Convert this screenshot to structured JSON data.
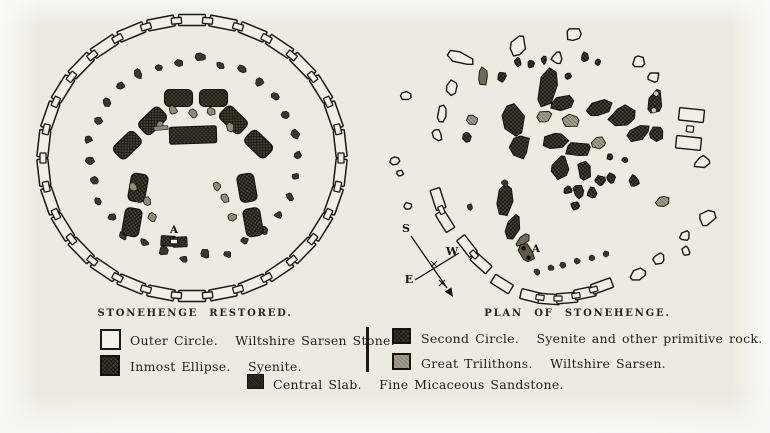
{
  "page": {
    "colors": {
      "paper": "#edeae1",
      "ink": "#241f17",
      "dark_stone": "#4b463a",
      "gray_stone": "#a39e8c",
      "outline_stone": "#f1eee6"
    }
  },
  "titles": {
    "left": "STONEHENGE RESTORED.",
    "right": "PLAN OF STONEHENGE."
  },
  "legend": {
    "outer_circle": {
      "label": "Outer Circle.   Wiltshire Sarsen Stone."
    },
    "inmost_ellipse": {
      "label": "Inmost Ellipse.   Syenite."
    },
    "central_slab": {
      "label": "Central Slab.   Fine Micaceous Sandstone."
    },
    "second_circle": {
      "label": "Second Circle.   Syenite and other primitive rock."
    },
    "great_trilithons": {
      "label": "Great Trilithons.   Wiltshire Sarsen."
    }
  },
  "left_plan": {
    "label_a": "A",
    "center": [
      172,
      154
    ],
    "outer_ring": {
      "rx": 149,
      "ry": 138,
      "links": 30,
      "link_len": 27,
      "link_w": 11,
      "joint_len": 10,
      "joint_w": 6
    },
    "bluestone_ring": {
      "rx": 103,
      "ry": 99,
      "count": 30
    },
    "trilithons": [
      [
        176,
        94,
        0
      ],
      [
        120,
        129,
        -44
      ],
      [
        226,
        128,
        44
      ],
      [
        115,
        201,
        -80
      ],
      [
        230,
        201,
        80
      ]
    ],
    "trilithon_stone": {
      "len": 28,
      "wid": 17,
      "gap": 7
    },
    "slab": [
      173,
      131,
      47,
      17,
      -2
    ],
    "gray_dots": [
      [
        153,
        106
      ],
      [
        173,
        109
      ],
      [
        191,
        107
      ],
      [
        140,
        121
      ],
      [
        210,
        123
      ],
      [
        113,
        183
      ],
      [
        127,
        197
      ],
      [
        132,
        213
      ],
      [
        205,
        194
      ],
      [
        212,
        213
      ],
      [
        197,
        182
      ]
    ],
    "gray_bar": [
      141,
      124,
      14,
      4
    ],
    "a_pos": [
      154,
      229
    ],
    "pair": [
      [
        148,
        237,
        4
      ],
      [
        160,
        238,
        -3
      ]
    ],
    "pair_size": [
      14,
      10
    ]
  },
  "right_plan": {
    "label_a": "A",
    "a_pos": [
      151,
      252
    ],
    "compass": {
      "labels": {
        "s": "S",
        "w": "W",
        "e": "E"
      },
      "s_pos": [
        21,
        232
      ],
      "w_pos": [
        67,
        255
      ],
      "e_pos": [
        24,
        283
      ],
      "line1": [
        [
          26,
          236
        ],
        [
          62,
          288
        ]
      ],
      "line2": [
        [
          30,
          280
        ],
        [
          74,
          253
        ]
      ],
      "arrow_tip": [
        68,
        297
      ],
      "ticks": [
        [
          49,
          264
        ],
        [
          57,
          283
        ]
      ]
    },
    "stones": [
      [
        75,
        58,
        28,
        12,
        22,
        "o"
      ],
      [
        67,
        88,
        13,
        16,
        -8,
        "o"
      ],
      [
        57,
        114,
        9,
        20,
        10,
        "o"
      ],
      [
        52,
        135,
        9,
        13,
        -25,
        "o"
      ],
      [
        21,
        96,
        13,
        9,
        10,
        "o"
      ],
      [
        10,
        161,
        10,
        8,
        0,
        "o"
      ],
      [
        15,
        173,
        7,
        6,
        0,
        "o"
      ],
      [
        23,
        206,
        9,
        7,
        0,
        "o"
      ],
      [
        133,
        46,
        17,
        22,
        8,
        "o"
      ],
      [
        189,
        34,
        18,
        14,
        -12,
        "o"
      ],
      [
        172,
        58,
        11,
        13,
        0,
        "o"
      ],
      [
        254,
        62,
        13,
        12,
        15,
        "o"
      ],
      [
        269,
        77,
        12,
        10,
        -10,
        "o"
      ],
      [
        270,
        102,
        16,
        30,
        8,
        "d2"
      ],
      [
        305,
        129,
        20,
        52,
        6,
        "ol"
      ],
      [
        317,
        162,
        17,
        12,
        -22,
        "o"
      ],
      [
        322,
        218,
        18,
        14,
        -32,
        "o"
      ],
      [
        300,
        236,
        11,
        10,
        -30,
        "o"
      ],
      [
        301,
        251,
        8,
        10,
        0,
        "o"
      ],
      [
        274,
        259,
        14,
        11,
        -35,
        "o"
      ],
      [
        253,
        275,
        16,
        12,
        -30,
        "o"
      ],
      [
        163,
        88,
        19,
        44,
        9,
        "d"
      ],
      [
        128,
        120,
        23,
        32,
        -14,
        "d"
      ],
      [
        135,
        147,
        21,
        25,
        26,
        "d"
      ],
      [
        178,
        103,
        27,
        15,
        -8,
        "d"
      ],
      [
        213,
        108,
        29,
        17,
        -20,
        "d"
      ],
      [
        238,
        116,
        31,
        19,
        -25,
        "d"
      ],
      [
        253,
        133,
        25,
        15,
        -32,
        "d"
      ],
      [
        271,
        134,
        15,
        18,
        -8,
        "d"
      ],
      [
        170,
        141,
        27,
        18,
        8,
        "d"
      ],
      [
        193,
        149,
        29,
        16,
        -4,
        "d"
      ],
      [
        175,
        168,
        18,
        25,
        4,
        "d"
      ],
      [
        199,
        170,
        14,
        21,
        -12,
        "d"
      ],
      [
        215,
        181,
        12,
        11,
        0,
        "d"
      ],
      [
        183,
        190,
        10,
        9,
        0,
        "d"
      ],
      [
        117,
        77,
        10,
        10,
        0,
        "d"
      ],
      [
        133,
        62,
        7,
        10,
        0,
        "d"
      ],
      [
        146,
        64,
        7,
        8,
        0,
        "d"
      ],
      [
        159,
        60,
        6,
        9,
        0,
        "d"
      ],
      [
        200,
        57,
        8,
        10,
        0,
        "d"
      ],
      [
        213,
        62,
        6,
        7,
        0,
        "d"
      ],
      [
        183,
        76,
        7,
        7,
        0,
        "d"
      ],
      [
        82,
        137,
        9,
        11,
        0,
        "d"
      ],
      [
        120,
        199,
        16,
        38,
        12,
        "d"
      ],
      [
        128,
        227,
        13,
        27,
        18,
        "d"
      ],
      [
        194,
        191,
        12,
        15,
        -10,
        "d"
      ],
      [
        207,
        193,
        10,
        12,
        0,
        "d"
      ],
      [
        190,
        206,
        9,
        9,
        0,
        "d"
      ],
      [
        226,
        178,
        9,
        11,
        0,
        "d"
      ],
      [
        249,
        181,
        11,
        13,
        -15,
        "d"
      ],
      [
        225,
        157,
        7,
        7,
        0,
        "d"
      ],
      [
        240,
        160,
        6,
        6,
        0,
        "d"
      ],
      [
        186,
        121,
        19,
        13,
        6,
        "g"
      ],
      [
        159,
        117,
        17,
        12,
        -18,
        "g"
      ],
      [
        213,
        143,
        16,
        12,
        -15,
        "g"
      ],
      [
        87,
        120,
        13,
        11,
        20,
        "g"
      ],
      [
        278,
        202,
        15,
        11,
        -25,
        "g"
      ],
      [
        98,
        76,
        11,
        21,
        6,
        "dg"
      ],
      [
        138,
        240,
        18,
        9,
        -38,
        "dg"
      ],
      [
        141,
        253,
        15,
        21,
        -28,
        "dd"
      ]
    ],
    "dots": [
      [
        85,
        207
      ],
      [
        120,
        183
      ],
      [
        152,
        272
      ],
      [
        166,
        268
      ],
      [
        178,
        265
      ],
      [
        192,
        261
      ],
      [
        207,
        258
      ],
      [
        221,
        254
      ]
    ],
    "chains": {
      "link_len": 21,
      "link_w": 10,
      "joint_len": 8,
      "joint_w": 5,
      "paths": [
        [
          [
            53,
            199,
            72
          ],
          [
            60,
            221,
            58
          ]
        ],
        [
          [
            82,
            246,
            52
          ],
          [
            96,
            263,
            42
          ]
        ],
        [
          [
            117,
            284,
            32
          ]
        ],
        [
          [
            146,
            296,
            14
          ],
          [
            164,
            299,
            4
          ],
          [
            182,
            298,
            -5
          ],
          [
            200,
            293,
            -12
          ],
          [
            217,
            286,
            -20
          ]
        ]
      ]
    }
  },
  "layout_note": "engraved double plan of Stonehenge with legend"
}
